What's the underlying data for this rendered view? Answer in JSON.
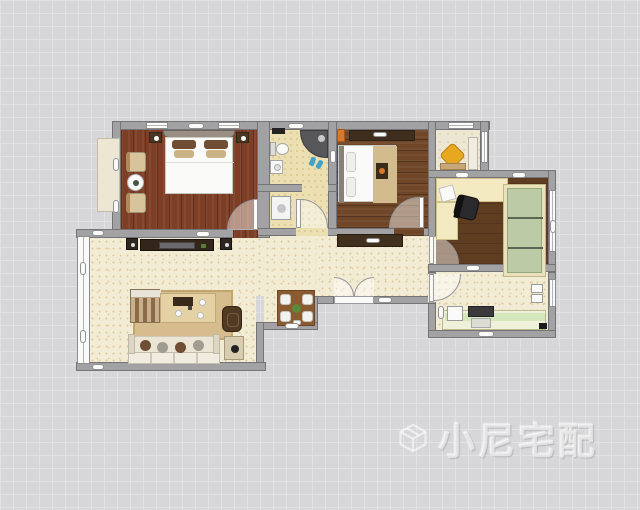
{
  "watermark": {
    "text": "小尼宅配",
    "logo_icon": "cube-logo-icon"
  },
  "palette": {
    "bg": "#d7d7d9",
    "grid": "#e2e2e4",
    "wall": "#a2a2a4",
    "wallEdge": "#747477",
    "masterFloorA": "#7d3e26",
    "masterFloorB": "#662f1d",
    "woodA": "#6f4627",
    "woodB": "#54341c",
    "studyA": "#5f3d20",
    "tile": "#ecdfb2",
    "tileDot": "#d8c58c",
    "speckle": "#f3ecd4",
    "speckleDot": "#dccaa1",
    "cream": "#ece6d3",
    "desk": "#f3eac1",
    "cabGreen": "#bccaa6",
    "cabFrame": "#e9e1ba",
    "cabShelf": "#5b6750",
    "counter": "#eff1da",
    "counterIn": "#d6e6bd",
    "rug": "#d7bd8d",
    "rugEdge": "#c2a66c",
    "tvDark": "#34251a",
    "woodFurn": "#8a5a30",
    "darkFurn": "#4a3523",
    "sofa": "#ebe5d6",
    "pillowA": "#6f4e33",
    "pillowB": "#a09c92",
    "yellow": "#e7a81f",
    "orange": "#d9772a",
    "blue": "#3fa3cc",
    "white": "#fafaf8",
    "green": "#5a8a3a",
    "wm": "rgba(255,255,255,0.55)"
  }
}
